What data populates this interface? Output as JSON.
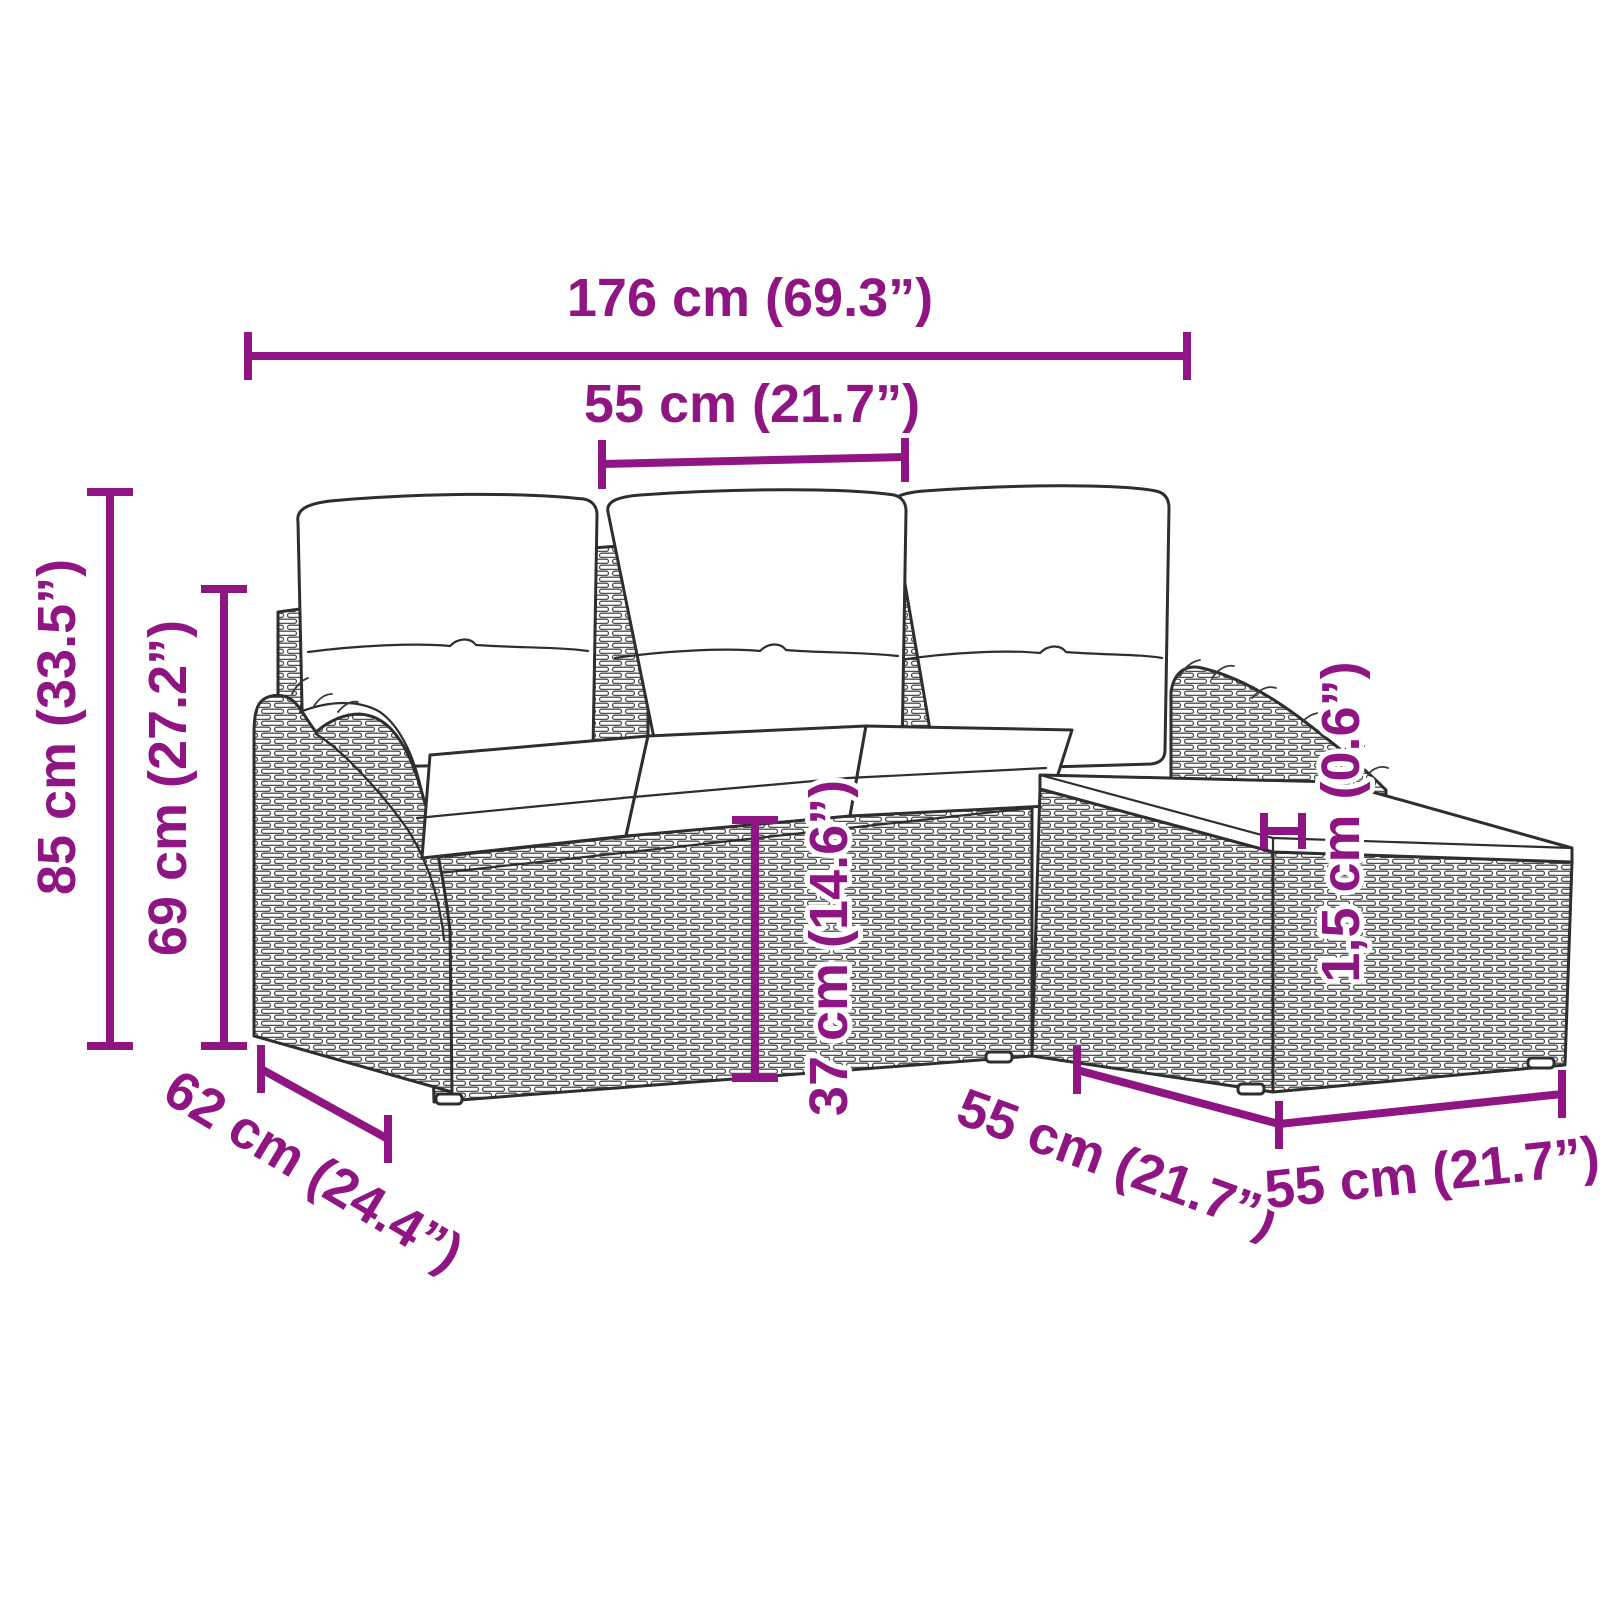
{
  "diagram": {
    "type": "product-dimension-diagram",
    "subject": "rattan garden sofa set with ottoman and cushions",
    "accent_color": "#8E1582",
    "outline_color": "#2e2e2e",
    "dims": {
      "total_width": {
        "label": "176 cm (69.3”)"
      },
      "middle_seat_width": {
        "label": "55 cm (21.7”)"
      },
      "total_height": {
        "label": "85 cm (33.5”)"
      },
      "backrest_height": {
        "label": "69 cm (27.2”)"
      },
      "seat_height": {
        "label": "37 cm (14.6”)"
      },
      "cushion_thickness": {
        "label": "1,5 cm (0.6”)"
      },
      "sofa_depth": {
        "label": "62 cm (24.4”)"
      },
      "ottoman_depth": {
        "label": "55 cm (21.7”)"
      },
      "ottoman_width": {
        "label": "55 cm (21.7”)"
      }
    }
  }
}
